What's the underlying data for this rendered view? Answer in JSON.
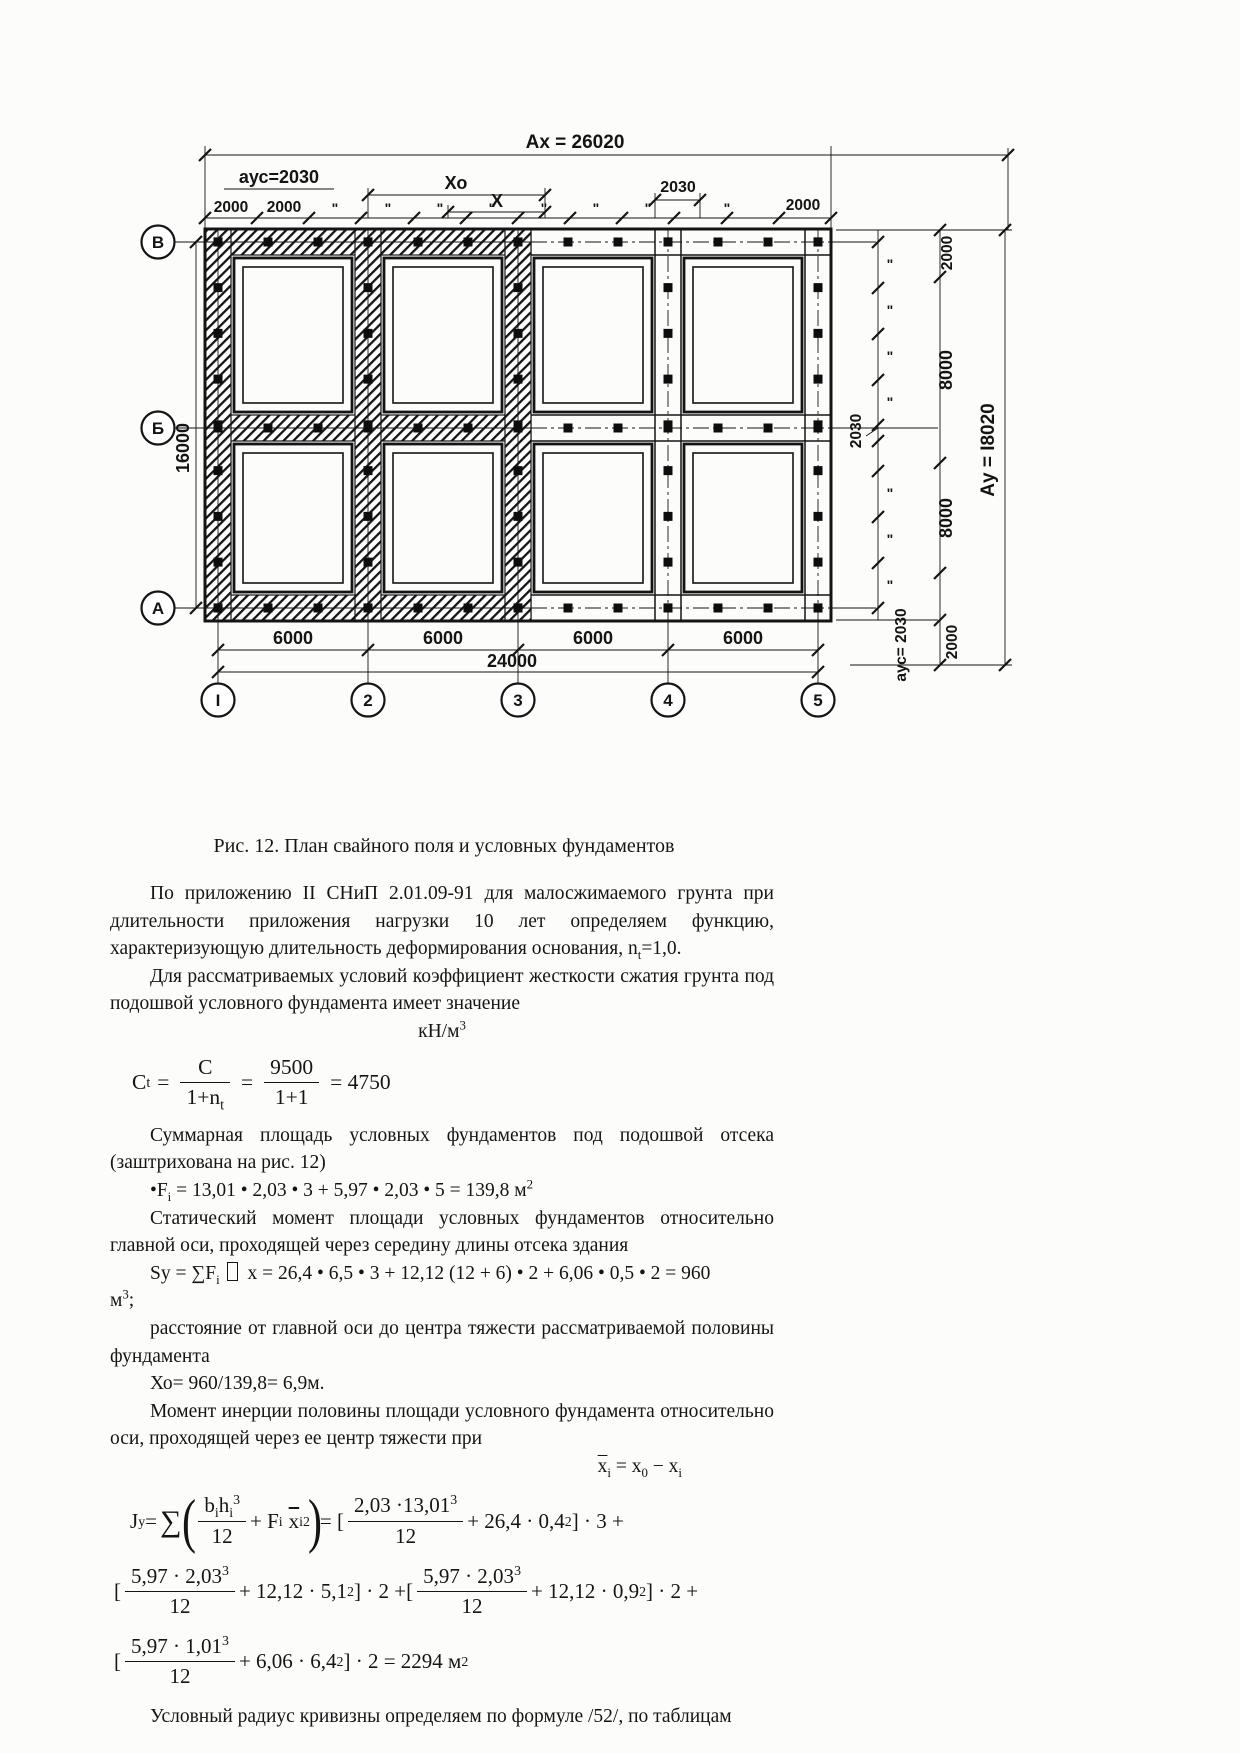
{
  "figure": {
    "caption": "Рис. 12. План свайного поля и условных фундаментов",
    "dims": {
      "ax_total": "Ах = 26020",
      "ays_top": "аус=2030",
      "xo": "Хо",
      "x": "Х",
      "top_2030": "2030",
      "c2000_1": "2000",
      "c2000_2": "2000",
      "c2000_r": "2000",
      "ditto": "\"",
      "bay": "6000",
      "total_x": "24000",
      "h16000": "16000",
      "r2000_top": "2000",
      "r8000_up": "8000",
      "r2030_mid": "2030",
      "r8000_lo": "8000",
      "r2000_bot": "2000",
      "ay_total": "Ау = I8020",
      "ays_bottom": "аус= 2030"
    },
    "row_axes": [
      "В",
      "Б",
      "А"
    ],
    "col_axes": [
      "I",
      "2",
      "3",
      "4",
      "5"
    ]
  },
  "content": {
    "p1a": "По приложению II СНиП 2.01.09-91 для малосжимаемого грунта при длительности приложения нагрузки 10 лет определяем функцию, характеризующую длительность деформирования основания, n",
    "p1sub": "t",
    "p1b": "=1,0.",
    "p2": "Для рассматриваемых условий коэффициент жесткости сжатия грунта под подошвой условного фундамента имеет значение",
    "unit_base": "кН/м",
    "unit_sup": "3",
    "p3": "Суммарная площадь условных фундаментов под подошвой отсека (заштрихована на рис. 12)",
    "p4": "Статический момент площади условных фундаментов относительно главной оси, проходящей через середину длины отсека здания",
    "p5": "расстояние от главной оси до центра тяжести рассматриваемой половины фундамента",
    "p6": "Хо= 960/139,8= 6,9м.",
    "p7": "Момент инерции половины площади условного фундамента относительно оси, проходящей через ее центр тяжести при",
    "p8": "Условный радиус кривизны определяем по формуле /52/, по таблицам"
  },
  "formulas": {
    "ct": {
      "lhs": "C",
      "lhs_sub": "t",
      "eq": "=",
      "num1": "C",
      "den1": "1+n",
      "den1_sub": "t",
      "eq2": "=",
      "num2": "9500",
      "den2": "1+1",
      "res": "= 4750"
    },
    "fi": {
      "a": "•F",
      "sub": "i",
      "b": " = 13,01 • 2,03 • 3 + 5,97 • 2,03 • 5 = 139,8 м",
      "sup": "2"
    },
    "sy": {
      "a": "Sy = ∑F",
      "sub": "i",
      "b": " x = 26,4 • 6,5 • 3 + 12,12 (12 + 6) • 2 + 6,06 • 0,5 • 2 = 960",
      "tail": "м",
      "tail_sup": "3",
      "tail2": ";"
    },
    "xbar": {
      "a": "x",
      "a_sub": "i",
      "b": " = x",
      "b_sub": "0",
      "c": " − x",
      "c_sub": "i"
    },
    "jy": {
      "lhs": "J",
      "lhs_sub": "y",
      "eq": "=",
      "sum": "∑",
      "po": "(",
      "pc": ")",
      "n1a": "b",
      "n1as": "i",
      "n1b": "h",
      "n1bs": "i",
      "n1sup": "3",
      "d1": "12",
      "t1": "+ F",
      "t1s": "i",
      "t2": "x",
      "t2s": "i",
      "t2sup": "2",
      "eq2": "= [",
      "n2": "2,03 ·13,01",
      "n2sup": "3",
      "d2": "12",
      "t3": "+ 26,4 · 0,4",
      "t3sup": "2",
      "c1": "] · 3 +",
      "l2": [
        {
          "o": "[",
          "n": "5,97 · 2,03",
          "nsup": "3",
          "d": "12",
          "t": "+ 12,12 · 5,1",
          "tsup": "2",
          "c": "] · 2 +"
        },
        {
          "o": "[",
          "n": "5,97 · 2,03",
          "nsup": "3",
          "d": "12",
          "t": "+ 12,12 · 0,9",
          "tsup": "2",
          "c": "] · 2 +"
        }
      ],
      "l3": {
        "o": "[",
        "n": "5,97 · 1,01",
        "nsup": "3",
        "d": "12",
        "t": "+ 6,06 · 6,4",
        "tsup": "2",
        "c": "] · 2 = 2294 м",
        "csup": "2"
      }
    }
  }
}
